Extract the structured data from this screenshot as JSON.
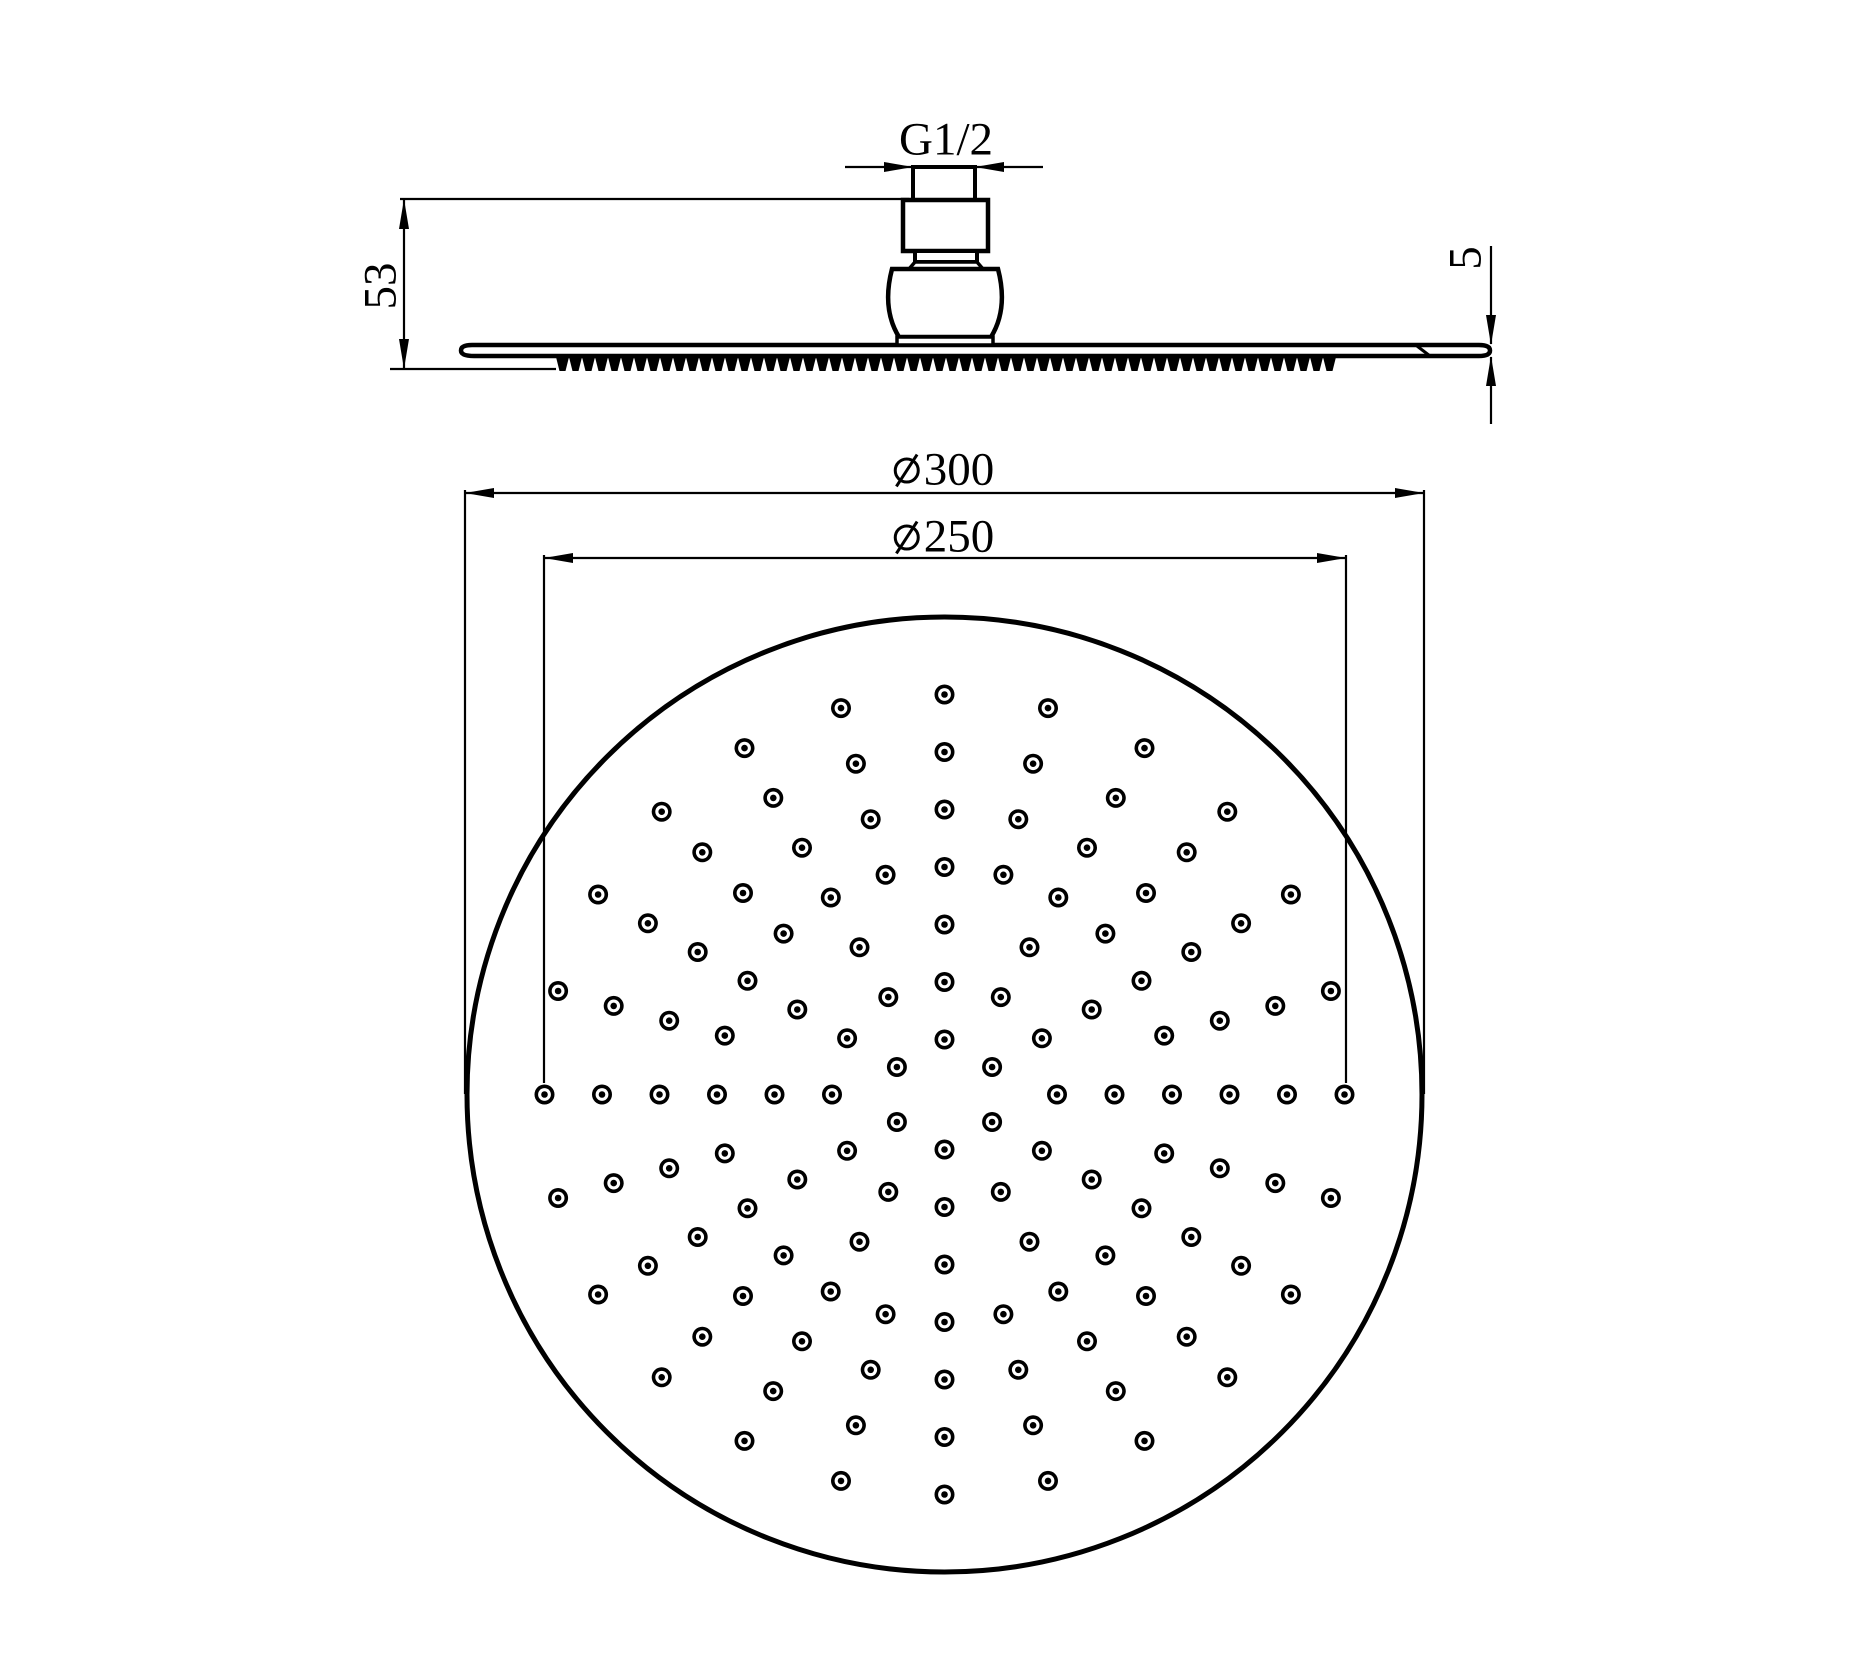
{
  "page": {
    "background": "#ffffff",
    "ink": "#000000"
  },
  "drawing": {
    "title": "Round rain shower head dimensional drawing",
    "views": {
      "side_view": "shower head profile with G1/2 threaded inlet connector",
      "plan_view": "spray face with nozzle hole pattern"
    },
    "dimensions": {
      "thread": {
        "label": "G1/2",
        "meaning": "inlet thread size"
      },
      "overall_height": {
        "label": "53",
        "value": 53,
        "unit": "mm",
        "meaning": "overall height of shower head"
      },
      "edge_thickness": {
        "label": "5",
        "value": 5,
        "unit": "mm",
        "meaning": "rim thickness"
      },
      "outer_diameter": {
        "label": "⌀300",
        "symbol": "⌀",
        "value_text": "300",
        "value": 300,
        "unit": "mm",
        "meaning": "overall face diameter"
      },
      "nozzle_circle_diameter": {
        "label": "⌀250",
        "symbol": "⌀",
        "value_text": "250",
        "value": 250,
        "unit": "mm",
        "meaning": "outermost nozzle ring diameter"
      }
    },
    "plan_circle": {
      "cx": 944.5,
      "cy": 1094.5,
      "r": 477.5
    },
    "nozzle_pattern": {
      "center": {
        "x": 944.5,
        "y": 1094.5
      },
      "dot_outer_radius": 10,
      "dot_inner_radius": 6.4,
      "dot_core_radius": 3.3,
      "rings": [
        {
          "radius": 55,
          "count": 6,
          "start_angle_deg": 30
        },
        {
          "radius": 112.5,
          "count": 12,
          "start_angle_deg": 0
        },
        {
          "radius": 170,
          "count": 12,
          "start_angle_deg": 0
        },
        {
          "radius": 227.5,
          "count": 24,
          "start_angle_deg": 0
        },
        {
          "radius": 285,
          "count": 24,
          "start_angle_deg": 0
        },
        {
          "radius": 342.5,
          "count": 24,
          "start_angle_deg": 0
        },
        {
          "radius": 400,
          "count": 24,
          "start_angle_deg": 0
        }
      ]
    },
    "spray_face_teeth": {
      "x_start": 556,
      "x_end": 1340,
      "top_y": 357,
      "bottom_y": 371,
      "tooth_pitch": 13,
      "foot_inset": 3.5
    }
  }
}
